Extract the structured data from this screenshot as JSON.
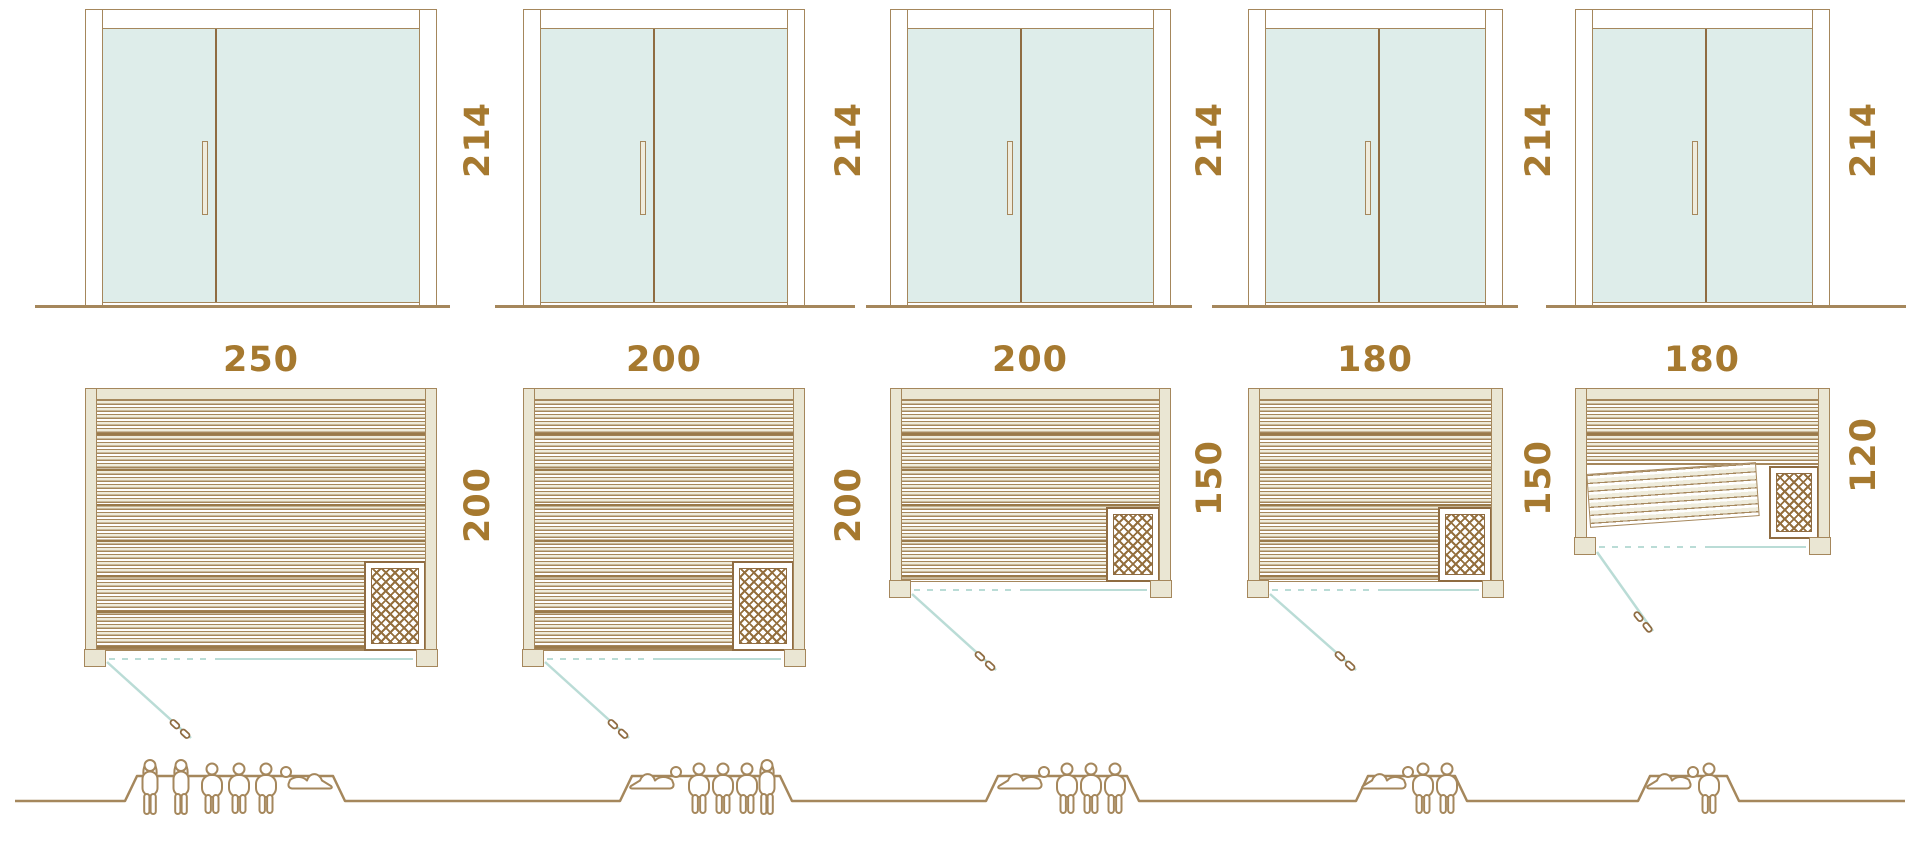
{
  "door": {
    "height_label_cm": "214"
  },
  "units": [
    {
      "width_cm": "250",
      "depth_cm": "200",
      "door_height_cm": "214",
      "capacity_people": 6,
      "capacity_breakdown": {
        "standing": 2,
        "sitting": 3,
        "lying": 1
      },
      "features": [
        "full-width benches",
        "corner heater bottom-right",
        "door hinged bottom-left"
      ]
    },
    {
      "width_cm": "200",
      "depth_cm": "200",
      "door_height_cm": "214",
      "capacity_people": 5,
      "capacity_breakdown": {
        "standing": 1,
        "sitting": 3,
        "lying": 1
      },
      "features": [
        "full-width benches",
        "corner heater bottom-right",
        "door hinged bottom-left"
      ]
    },
    {
      "width_cm": "200",
      "depth_cm": "150",
      "door_height_cm": "214",
      "capacity_people": 4,
      "capacity_breakdown": {
        "standing": 0,
        "sitting": 3,
        "lying": 1
      },
      "features": [
        "full-width benches",
        "corner heater bottom-right",
        "door hinged bottom-left"
      ]
    },
    {
      "width_cm": "180",
      "depth_cm": "150",
      "door_height_cm": "214",
      "capacity_people": 3,
      "capacity_breakdown": {
        "standing": 0,
        "sitting": 2,
        "lying": 1
      },
      "features": [
        "full-width benches",
        "corner heater bottom-right",
        "door hinged bottom-left"
      ]
    },
    {
      "width_cm": "180",
      "depth_cm": "120",
      "door_height_cm": "214",
      "capacity_people": 2,
      "capacity_breakdown": {
        "standing": 0,
        "sitting": 1,
        "lying": 1
      },
      "features": [
        "upper bench",
        "tilted lounger bench",
        "corner heater bottom-right",
        "door hinged bottom-left"
      ]
    }
  ],
  "colors": {
    "line_brown": "#a5875c",
    "text_brown": "#a6792f",
    "wall_beige": "#eae6d3",
    "glass_mint": "#deedea",
    "door_swing_teal": "#badcd6",
    "heater_lattice_brown": "#946f3e"
  }
}
